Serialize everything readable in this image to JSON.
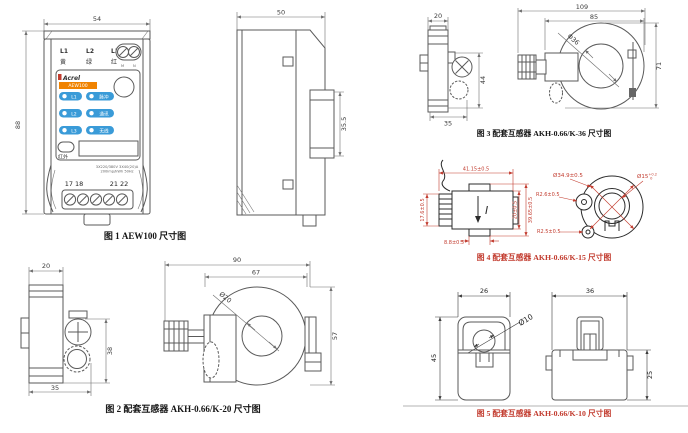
{
  "colors": {
    "accent_red": "#c23b2e",
    "line_gray": "#5a5a5a",
    "pill_blue": "#3a9bd8",
    "banner_orange": "#f08300"
  },
  "fig1": {
    "caption": "图 1 AEW100 尺寸图",
    "dims": {
      "width": "54",
      "height": "88"
    },
    "side": {
      "width": "50",
      "rail": "35.5"
    },
    "device": {
      "phases": [
        "L1",
        "L2",
        "L3"
      ],
      "phase_colors": [
        "黄",
        "绿",
        "红"
      ],
      "mn": [
        "M",
        "N"
      ],
      "brand": "Acrel",
      "model": "AEW100",
      "leds": [
        {
          "left": "L1",
          "right": "脉冲"
        },
        {
          "left": "L2",
          "right": "通讯"
        },
        {
          "left": "L3",
          "right": "无线"
        }
      ],
      "infrared": "红外",
      "rating1": "3X220/380V 3X40(20)A",
      "rating2": "200imp/kWh 50Hz",
      "terminals_left": "17 18",
      "terminals_right": "21 22"
    }
  },
  "fig2": {
    "caption": "图 2 配套互感器 AKH-0.66/K-20 尺寸图",
    "dims": {
      "side_top": "20",
      "side_right": "38",
      "side_bottom": "35",
      "total_w": "90",
      "body_w": "67",
      "height": "57",
      "hole": "Ø20"
    }
  },
  "fig3": {
    "caption": "图 3 配套互感器 AKH-0.66/K-36 尺寸图",
    "dims": {
      "side_top": "20",
      "side_right": "44",
      "side_bottom": "35",
      "total_w": "109",
      "body_w": "85",
      "height": "71",
      "hole": "Φ36"
    }
  },
  "fig4": {
    "caption": "图 4 配套互感器 AKH-0.66/K-15 尺寸图",
    "polarity": "I",
    "dims": {
      "width": "41.15±0.5",
      "left_h": "17.6±0.5",
      "base": "8.8±0.5",
      "inner_h": "20±0.5",
      "outer_h": "39.65±0.5",
      "outer_d": "Ø34.9±0.5",
      "hole": "Ø15",
      "hole_tol_up": "+0.2",
      "hole_tol_dn": "0",
      "r_up": "R2.6±0.5",
      "r_low": "R2.5±0.5"
    }
  },
  "fig5": {
    "caption": "图 5 配套互感器 AKH-0.66/K-10 尺寸图",
    "dims": {
      "left_w": "26",
      "left_h": "45",
      "hole": "Ø10",
      "right_w": "36",
      "right_h": "25"
    }
  }
}
